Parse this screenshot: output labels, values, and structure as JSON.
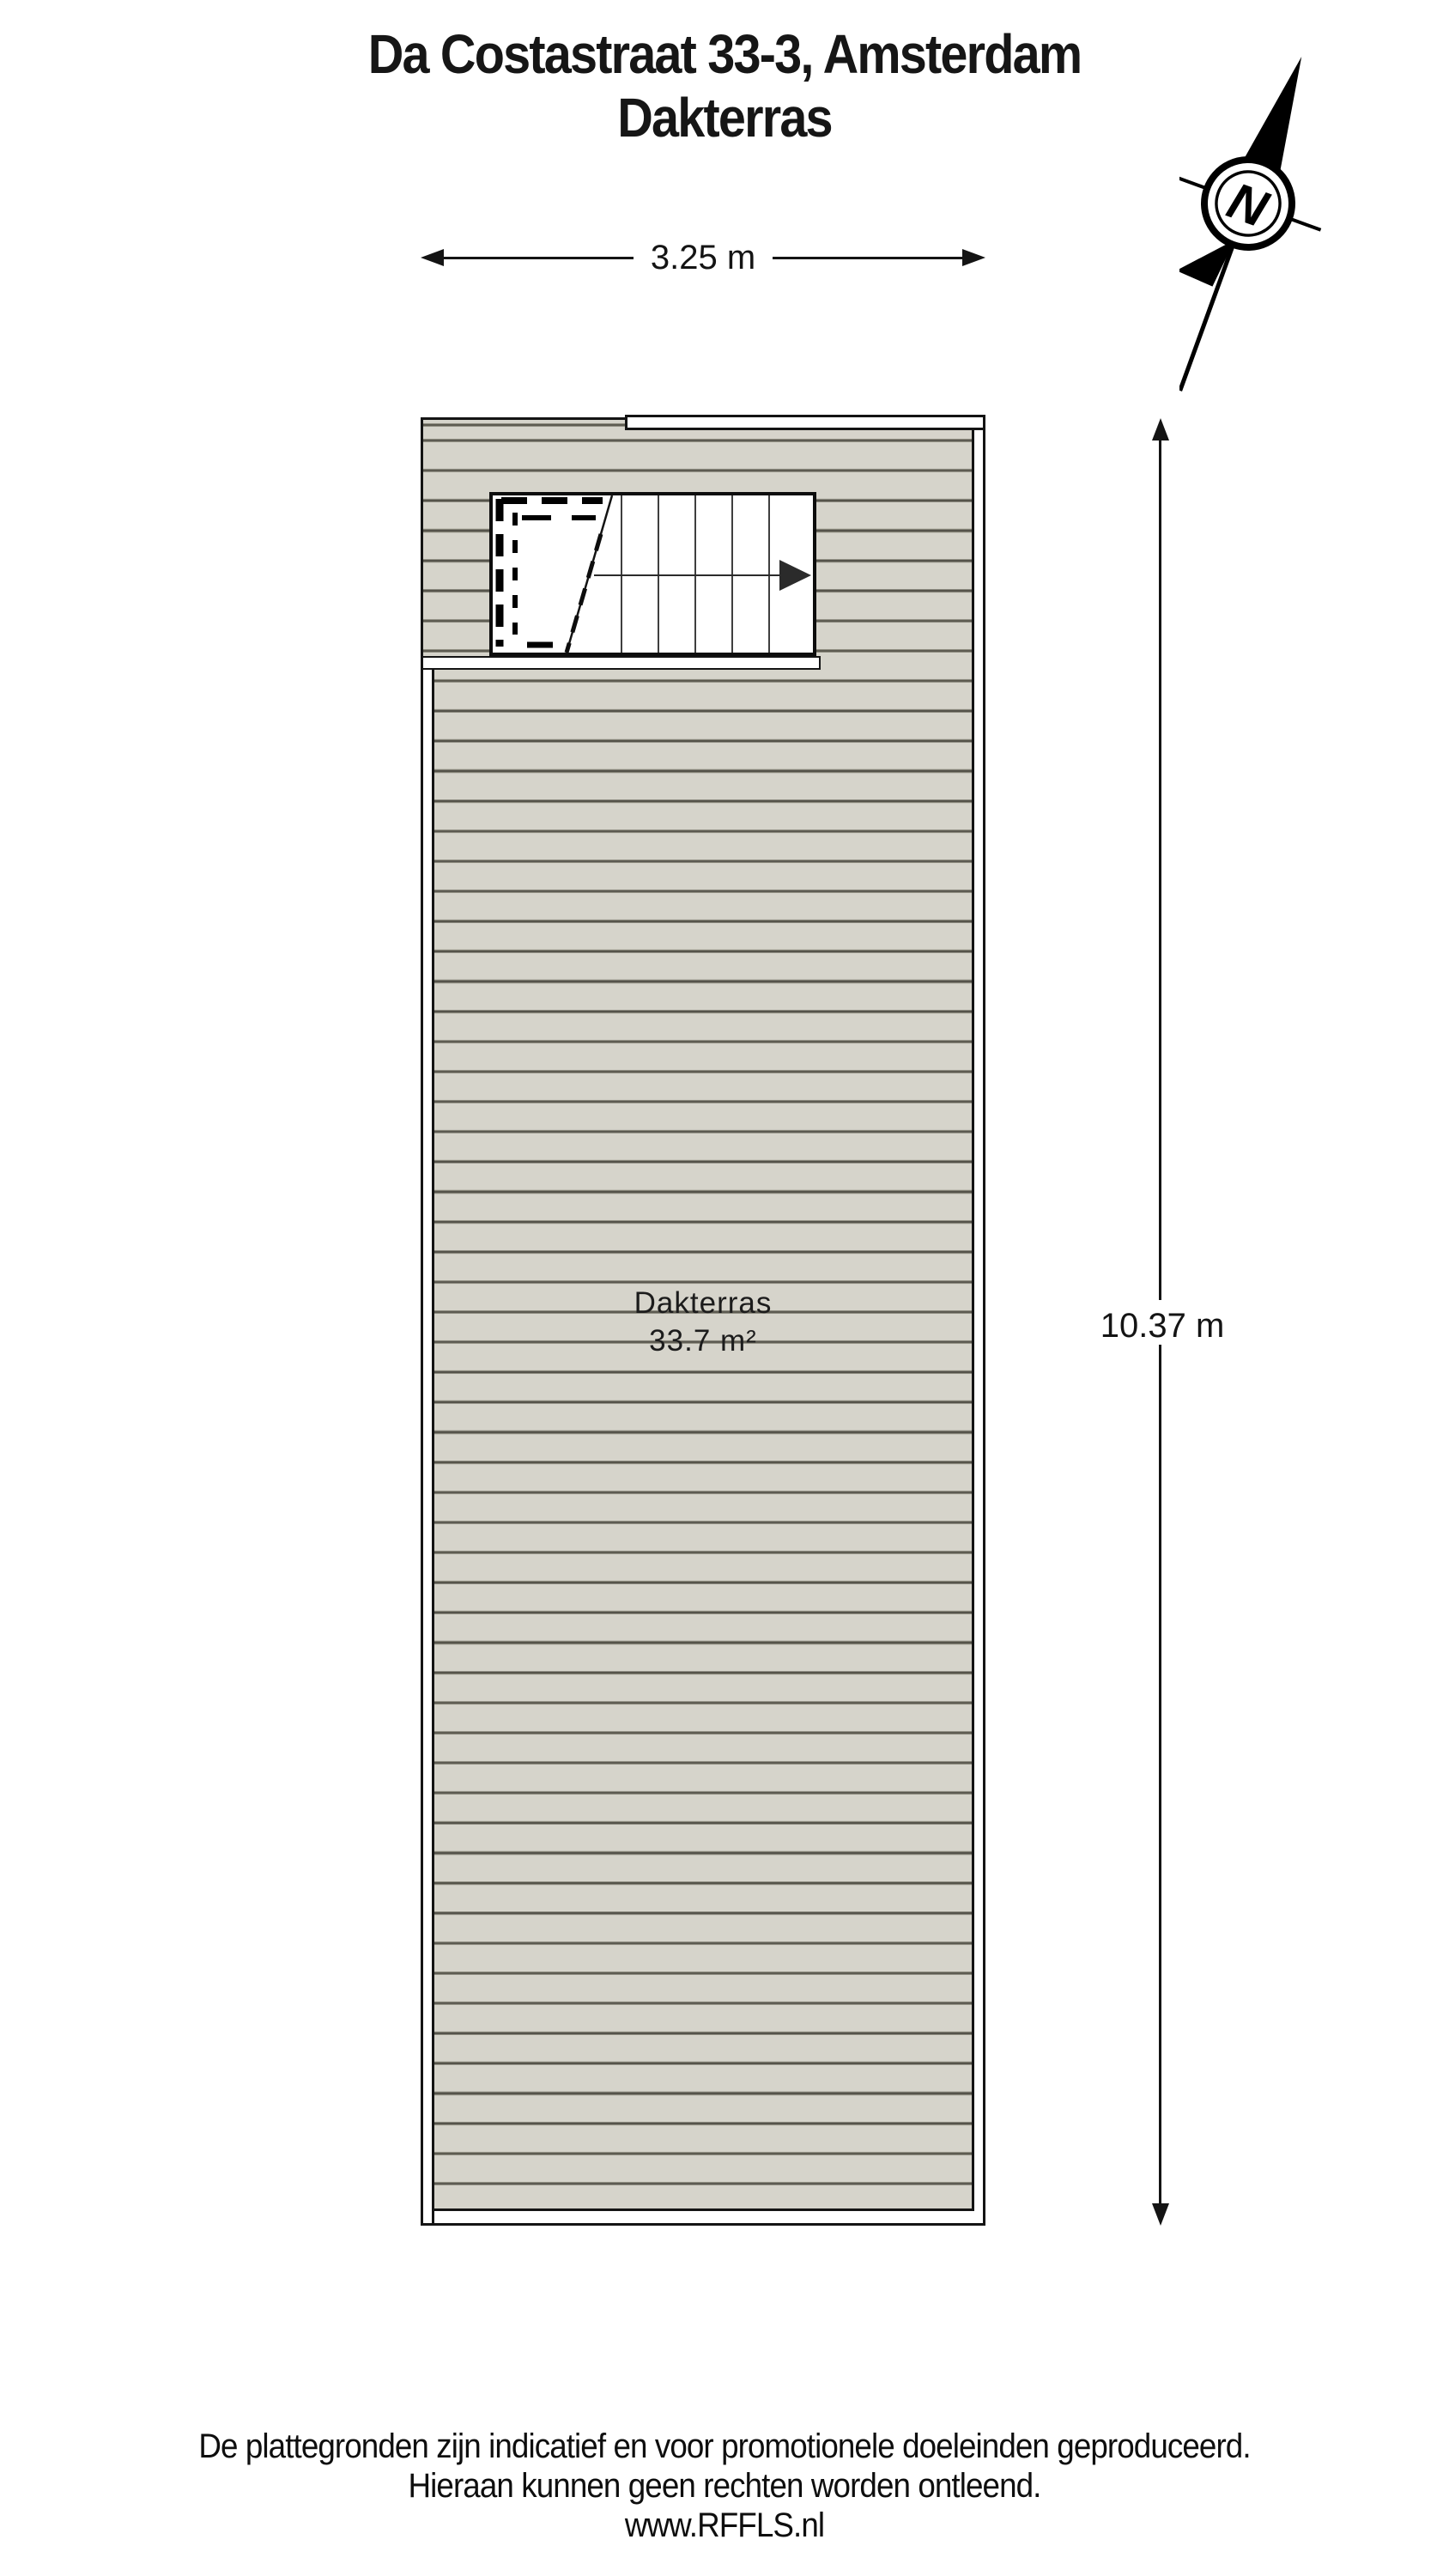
{
  "title": {
    "line1": "Da Costastraat 33-3, Amsterdam",
    "line2": "Dakterras"
  },
  "dimensions": {
    "horizontal": "3.25 m",
    "vertical": "10.37 m"
  },
  "room": {
    "name": "Dakterras",
    "area": "33.7 m²"
  },
  "compass": {
    "north_label": "N"
  },
  "footer": {
    "line1": "De plattegronden zijn indicatief en voor promotionele doeleinden geproduceerd.",
    "line2": "Hieraan kunnen geen rechten worden ontleend.",
    "line3": "www.RFFLS.nl"
  },
  "colors": {
    "background": "#ffffff",
    "deck_fill": "#d6d4cb",
    "deck_line": "#55534a",
    "outline": "#141414"
  }
}
